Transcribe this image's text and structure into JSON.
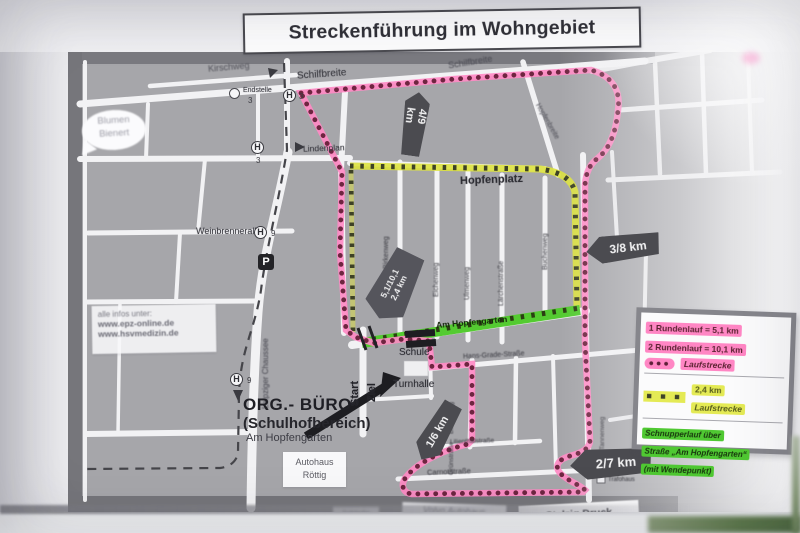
{
  "title": "Streckenführung im Wohngebiet",
  "legend": {
    "row1_line1": "1 Rundenlauf = 5,1 km",
    "row1_line2": "2 Rundenlauf = 10,1 km",
    "row1_dots": "●●●",
    "row1_label": "Laufstrecke",
    "row2_squares": "■ ■ ■",
    "row2_value": "2,4 km",
    "row2_label": "Laufstrecke",
    "row3_line1": "Schnupperlauf über",
    "row3_line2": "Straße „Am Hopfengarten“",
    "row3_line3": "(mit Wendepunkt)"
  },
  "km_markers": {
    "a": "4/9 km",
    "b": "3/8 km",
    "c1": "5,1/10,1",
    "c2": "2,4 km",
    "d": "1/6 km",
    "e": "2/7 km"
  },
  "streets": {
    "kirschweg": "Kirschweg",
    "schilfbreite_west": "Schilfbreite",
    "schilfbreite_east": "Schilfbreite",
    "lindenplan": "Lindenplan",
    "hopfenplatz": "Hopfenplatz",
    "hopfenbreite": "Hopfenbreite",
    "weinbrennerallee": "Weinbrennerallee",
    "leipziger_chaussee": "Leipziger Chaussee",
    "birkenweg": "Birkenweg",
    "eichenweg": "Eichenweg",
    "ulmenweg": "Ulmenweg",
    "laerchenstrasse": "Lärchenstraße",
    "buchenweg": "Buchenweg",
    "am_hopfengarten": "Am Hopfengarten",
    "hans_grade": "Hans-Grade-Straße",
    "bienenweg": "Bienenweg",
    "gruenstrasse": "Grünstraße",
    "lilienthalstrasse": "Lilienthalstraße",
    "tannenweg": "Tannenweg",
    "carnotstrasse": "Carnotstraße"
  },
  "places": {
    "blumen_line1": "Blumen",
    "blumen_line2": "Bienert",
    "endstelle": "Endstelle",
    "endstelle_line": "3",
    "schule": "Schule",
    "turnhalle": "Turnhalle",
    "start": "Start",
    "ziel": "Ziel",
    "org_line1": "ORG.- BÜRO",
    "org_line2": "(Schulhofbereich)",
    "org_line3": "Am Hopfengarten",
    "autohaus_line1": "Autohaus",
    "autohaus_line2": "Röttig",
    "volvo": "Volvo Autohaus",
    "stelzig": "Stelzig Druck",
    "somedia": "SoMedia",
    "trafohaus": "Trafohaus"
  },
  "info": {
    "line1": "alle infos unter:",
    "line2": "www.epz-online.de",
    "line3": "www.hsvmedizin.de"
  },
  "symbols": {
    "stop": "H",
    "parking": "P",
    "tram_line": "3",
    "bus_line": "9"
  },
  "colors": {
    "route_pink": "#ff8ac4",
    "route_dot": "#6e2540",
    "route_yellow": "#dde23e",
    "route_green": "#54cb31",
    "marker_bg": "#4b4b50",
    "legend_pink": "#ff86c4",
    "legend_yellow": "#e4ea55",
    "legend_green": "#4fc832"
  }
}
